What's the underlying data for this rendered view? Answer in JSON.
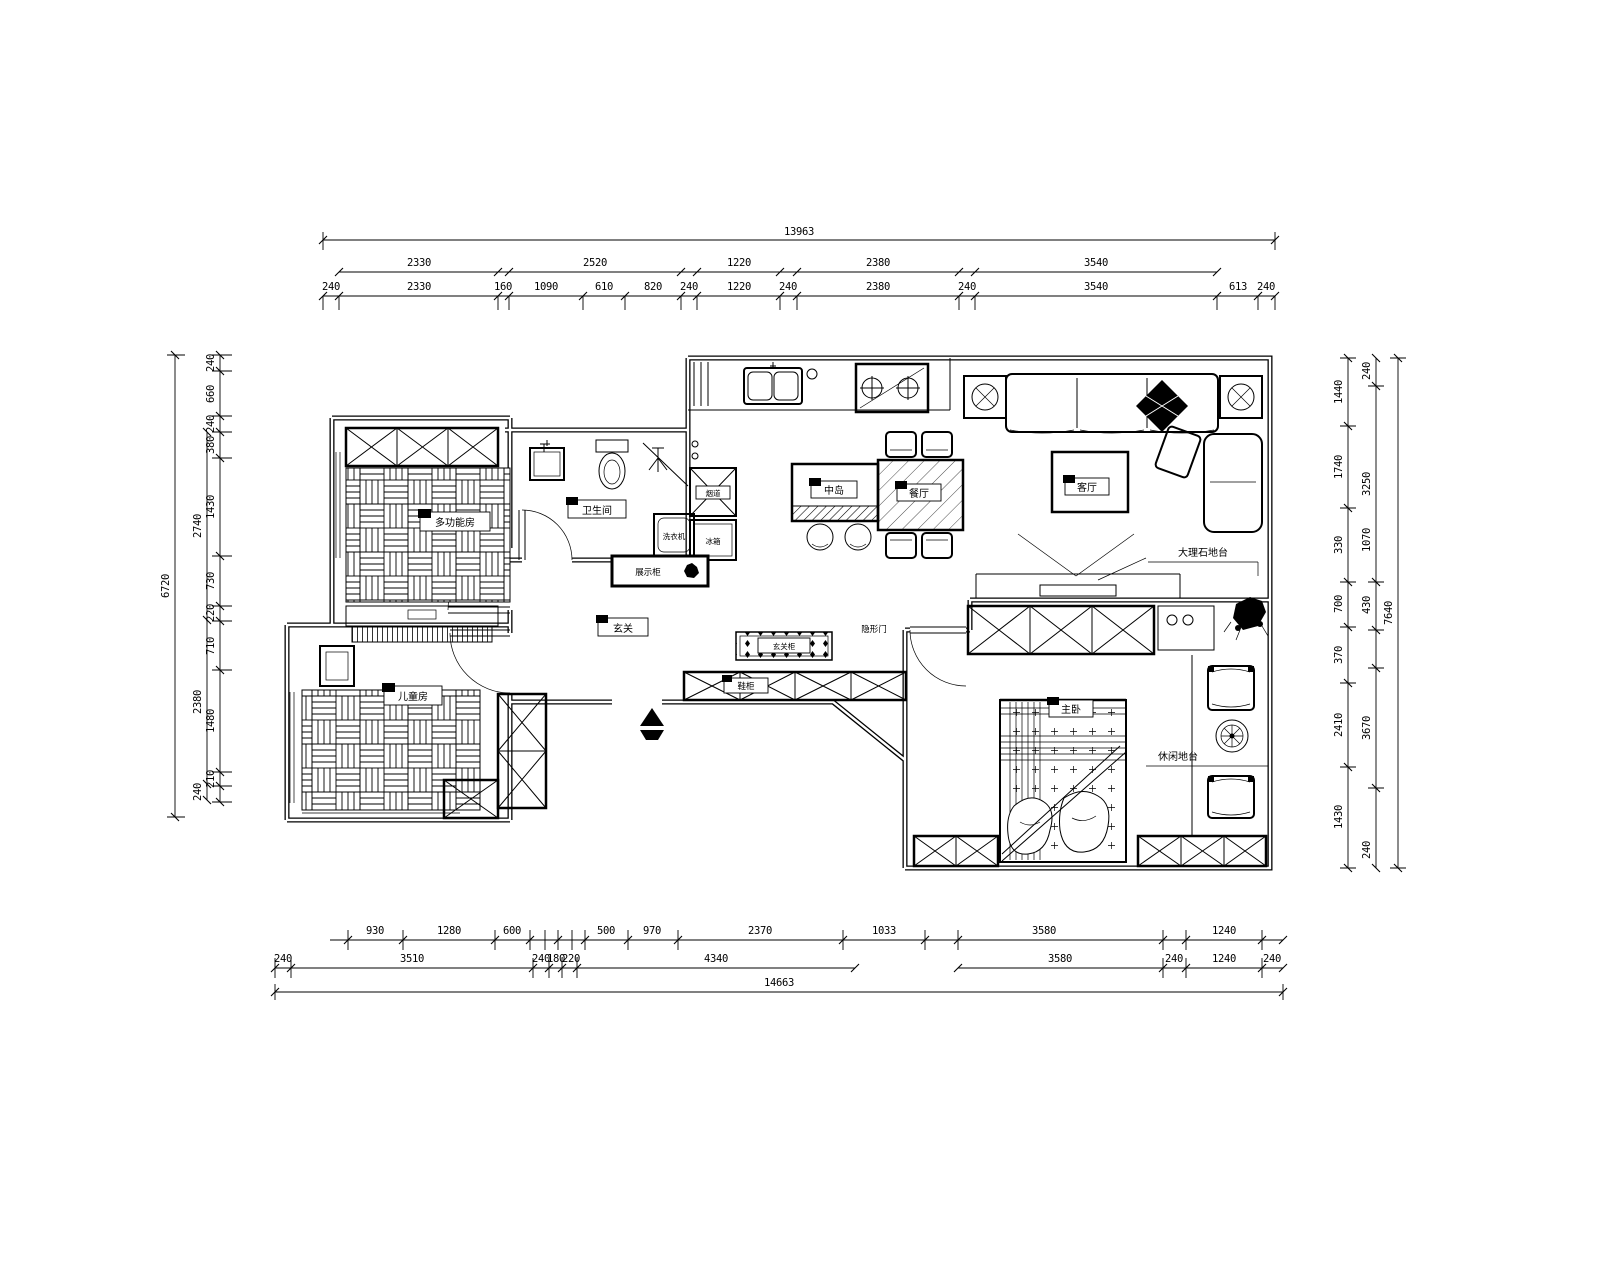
{
  "drawing": {
    "type": "residential floor plan, CAD style, black lines on white"
  },
  "dims": {
    "top": {
      "total": "13963",
      "row2": [
        "2330",
        "2520",
        "1220",
        "2380",
        "3540"
      ],
      "row3": [
        "240",
        "2330",
        "160",
        "1090",
        "610",
        "820",
        "240",
        "1220",
        "240",
        "2380",
        "240",
        "3540",
        "613",
        "240"
      ]
    },
    "bottom": {
      "row1": [
        "930",
        "1280",
        "600",
        "500",
        "970",
        "2370",
        "1033",
        "3580",
        "1240"
      ],
      "row2": [
        "240",
        "3510",
        "240",
        "180",
        "220",
        "4340",
        "3580",
        "240",
        "1240",
        "240"
      ],
      "total": "14663"
    },
    "left": {
      "total": "6720",
      "mid": [
        "2740",
        "2380",
        "240"
      ],
      "inner": [
        "240",
        "660",
        "240",
        "380",
        "1430",
        "730",
        "220",
        "710",
        "1480",
        "210"
      ]
    },
    "right": {
      "total": "7640",
      "mid": [
        "240",
        "3250",
        "1070",
        "430",
        "3670",
        "240"
      ],
      "inner": [
        "1440",
        "1740",
        "330",
        "700",
        "370",
        "2410",
        "1430"
      ]
    }
  },
  "rooms": {
    "multi": "多功能房",
    "kids": "儿童房",
    "bath": "卫生间",
    "island": "中岛",
    "dining": "餐厅",
    "living": "客厅",
    "master": "主卧",
    "marble": "大理石地台",
    "leisure": "休闲地台",
    "display": "展示柜",
    "entry": "玄关",
    "entry_cab": "玄关柜",
    "shoe": "鞋柜",
    "hidden": "隐形门",
    "flue": "烟道",
    "fridge": "冰箱",
    "washer": "洗衣机"
  }
}
